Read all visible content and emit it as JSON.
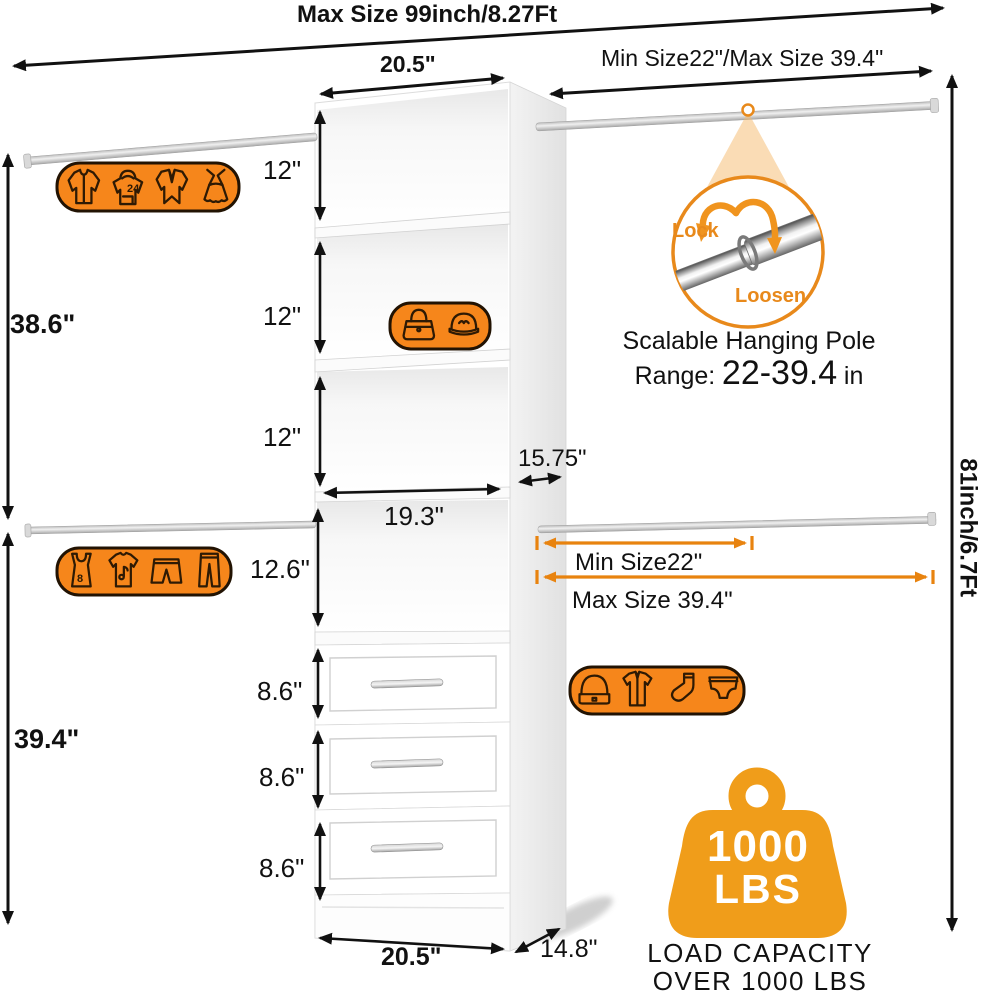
{
  "header": {
    "title": "Max Size 99inch/8.27Ft",
    "top_rod_label": "Min Size22\"/Max Size 39.4\"",
    "tower_width": "20.5\""
  },
  "left_dims": {
    "upper": "38.6\"",
    "lower": "39.4\""
  },
  "right_dims": {
    "total": "81inch/6.7Ft"
  },
  "tower_dims": {
    "shelf1": "12\"",
    "shelf2": "12\"",
    "shelf3": "12\"",
    "hanging": "12.6\"",
    "drawer1": "8.6\"",
    "drawer2": "8.6\"",
    "drawer3": "8.6\"",
    "interior_width": "19.3\"",
    "upper_depth": "15.75\"",
    "bottom_width": "20.5\"",
    "bottom_depth": "14.8\""
  },
  "lower_rod": {
    "min": "Min Size22\"",
    "max": "Max Size 39.4\""
  },
  "pole_detail": {
    "lock": "Lock",
    "loosen": "Loosen",
    "caption": "Scalable Hanging Pole",
    "range_prefix": "Range:",
    "range_value": "22-39.4",
    "range_unit": "in"
  },
  "load": {
    "value": "1000",
    "unit": "LBS",
    "line1": "LOAD CAPACITY",
    "line2": "OVER 1000 LBS"
  },
  "badges": {
    "hoodie_number": "24",
    "tank_number": "8",
    "top_left_icons": [
      "jacket",
      "hoodie",
      "coat",
      "dress"
    ],
    "shelf_icons": [
      "handbag",
      "cap"
    ],
    "lower_left_icons": [
      "tank-top",
      "t-shirt",
      "shorts",
      "pants"
    ],
    "drawer_side_icons": [
      "beanie",
      "shirt",
      "sock",
      "briefs"
    ]
  },
  "colors": {
    "badge_orange": "#F6861B",
    "arrow_orange": "#E8830F",
    "weight_orange": "#F09D1A",
    "ring_orange": "#E8891B",
    "arrow_black": "#111111"
  }
}
